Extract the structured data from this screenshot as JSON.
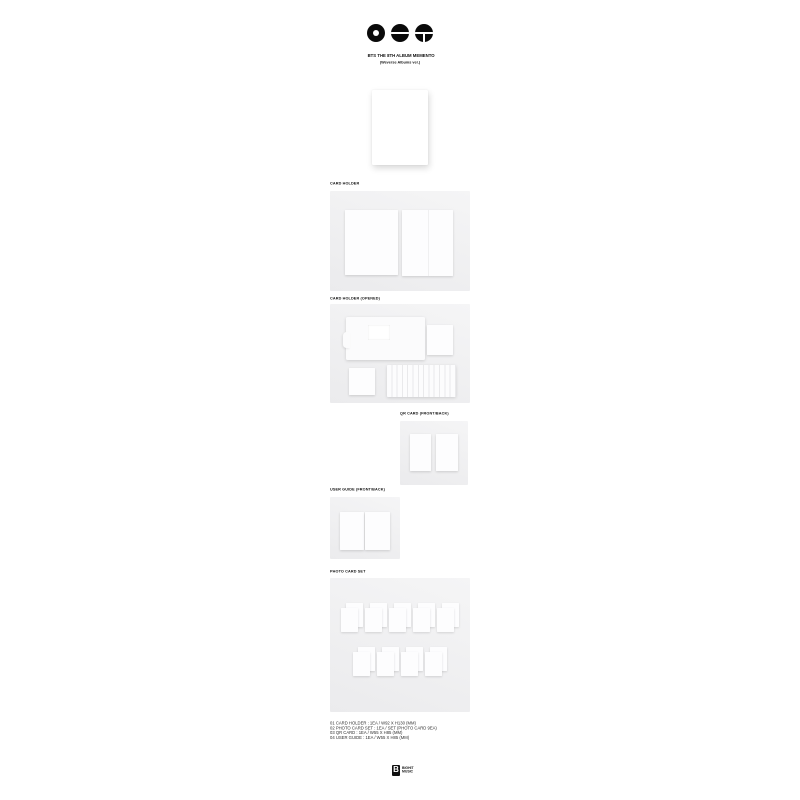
{
  "header": {
    "logo_icons": [
      "donut-circle-icon",
      "slit-circle-icon",
      "grid-circle-icon"
    ],
    "title_line1": "BTS THE 8TH ALBUM MEMENTO",
    "title_line2": "(Weverse Albums ver.)"
  },
  "sections": {
    "album_cover": {
      "description": "white album cover mockup"
    },
    "card_holder": {
      "label": "CARD HOLDER"
    },
    "card_holder_opened": {
      "label": "CARD HOLDER (OPENED)"
    },
    "qr_card": {
      "label": "QR CARD (FRONT/BACK)"
    },
    "user_guide": {
      "label": "USER GUIDE (FRONT/BACK)"
    },
    "photo_card_set": {
      "label": "PHOTO CARD SET",
      "top_row_count": 5,
      "bottom_row_count": 4,
      "card_count": 9
    }
  },
  "contents_list": {
    "lines": [
      "01 CARD HOLDER : 1EA / W92 X H130 (MM)",
      "02 PHOTO CARD SET : 1EA / SET (PHOTO CARD 9EA)",
      "03 QR CARD : 1EA / W55 X H85 (MM)",
      "04 USER GUIDE : 1EA / W55 X H85 (MM)"
    ]
  },
  "footer": {
    "brand_mark": "B",
    "brand_line1": "BIGHIT",
    "brand_line2": "MUSIC"
  },
  "colors": {
    "background": "#ffffff",
    "panel": "#f0f0f2",
    "card": "#fdfdfe",
    "ink": "#101010"
  }
}
